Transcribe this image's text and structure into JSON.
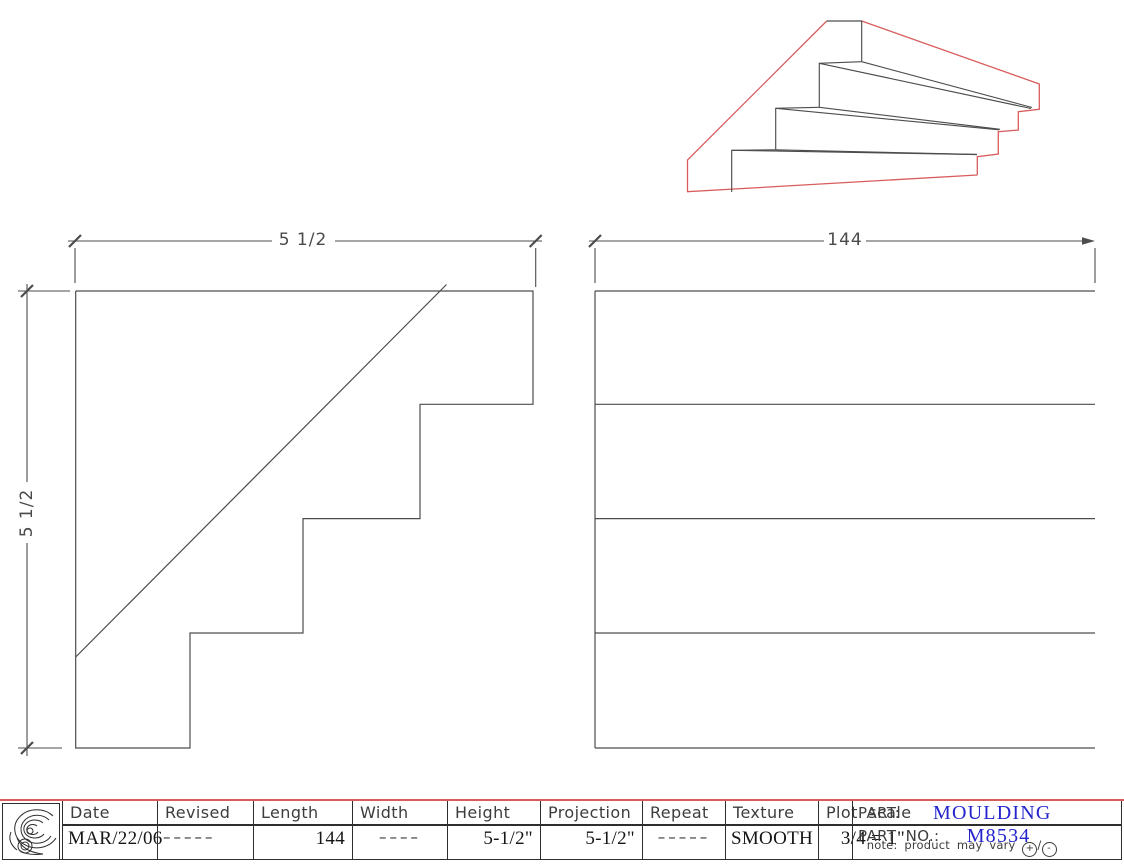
{
  "colors": {
    "red": "#d95c5c",
    "blue": "#2424cc",
    "line": "#4d4d4d"
  },
  "drawing": {
    "profile_view": {
      "width_dim": "5 1/2",
      "height_dim": "5 1/2"
    },
    "side_view": {
      "length_dim": "144"
    }
  },
  "title_block": {
    "columns": [
      {
        "label": "Date",
        "value": "MAR/22/06",
        "dashes": false
      },
      {
        "label": "Revised",
        "value": "–––––",
        "dashes": true
      },
      {
        "label": "Length",
        "value": "144",
        "dashes": false
      },
      {
        "label": "Width",
        "value": "––––",
        "dashes": true
      },
      {
        "label": "Height",
        "value": "5-1/2\"",
        "dashes": false
      },
      {
        "label": "Projection",
        "value": "5-1/2\"",
        "dashes": false
      },
      {
        "label": "Repeat",
        "value": "–––––",
        "dashes": true
      },
      {
        "label": "Texture",
        "value": "SMOOTH",
        "dashes": false
      },
      {
        "label": "Plot scale",
        "value": "3/4 = 1\"",
        "dashes": false
      }
    ],
    "part": {
      "label": "PART:",
      "value": "MOULDING"
    },
    "part_no": {
      "label": "PART NO.:",
      "value": "M8534"
    },
    "note": {
      "text": "note: product may vary",
      "plus": "+",
      "slash": "/",
      "minus": "-"
    }
  }
}
